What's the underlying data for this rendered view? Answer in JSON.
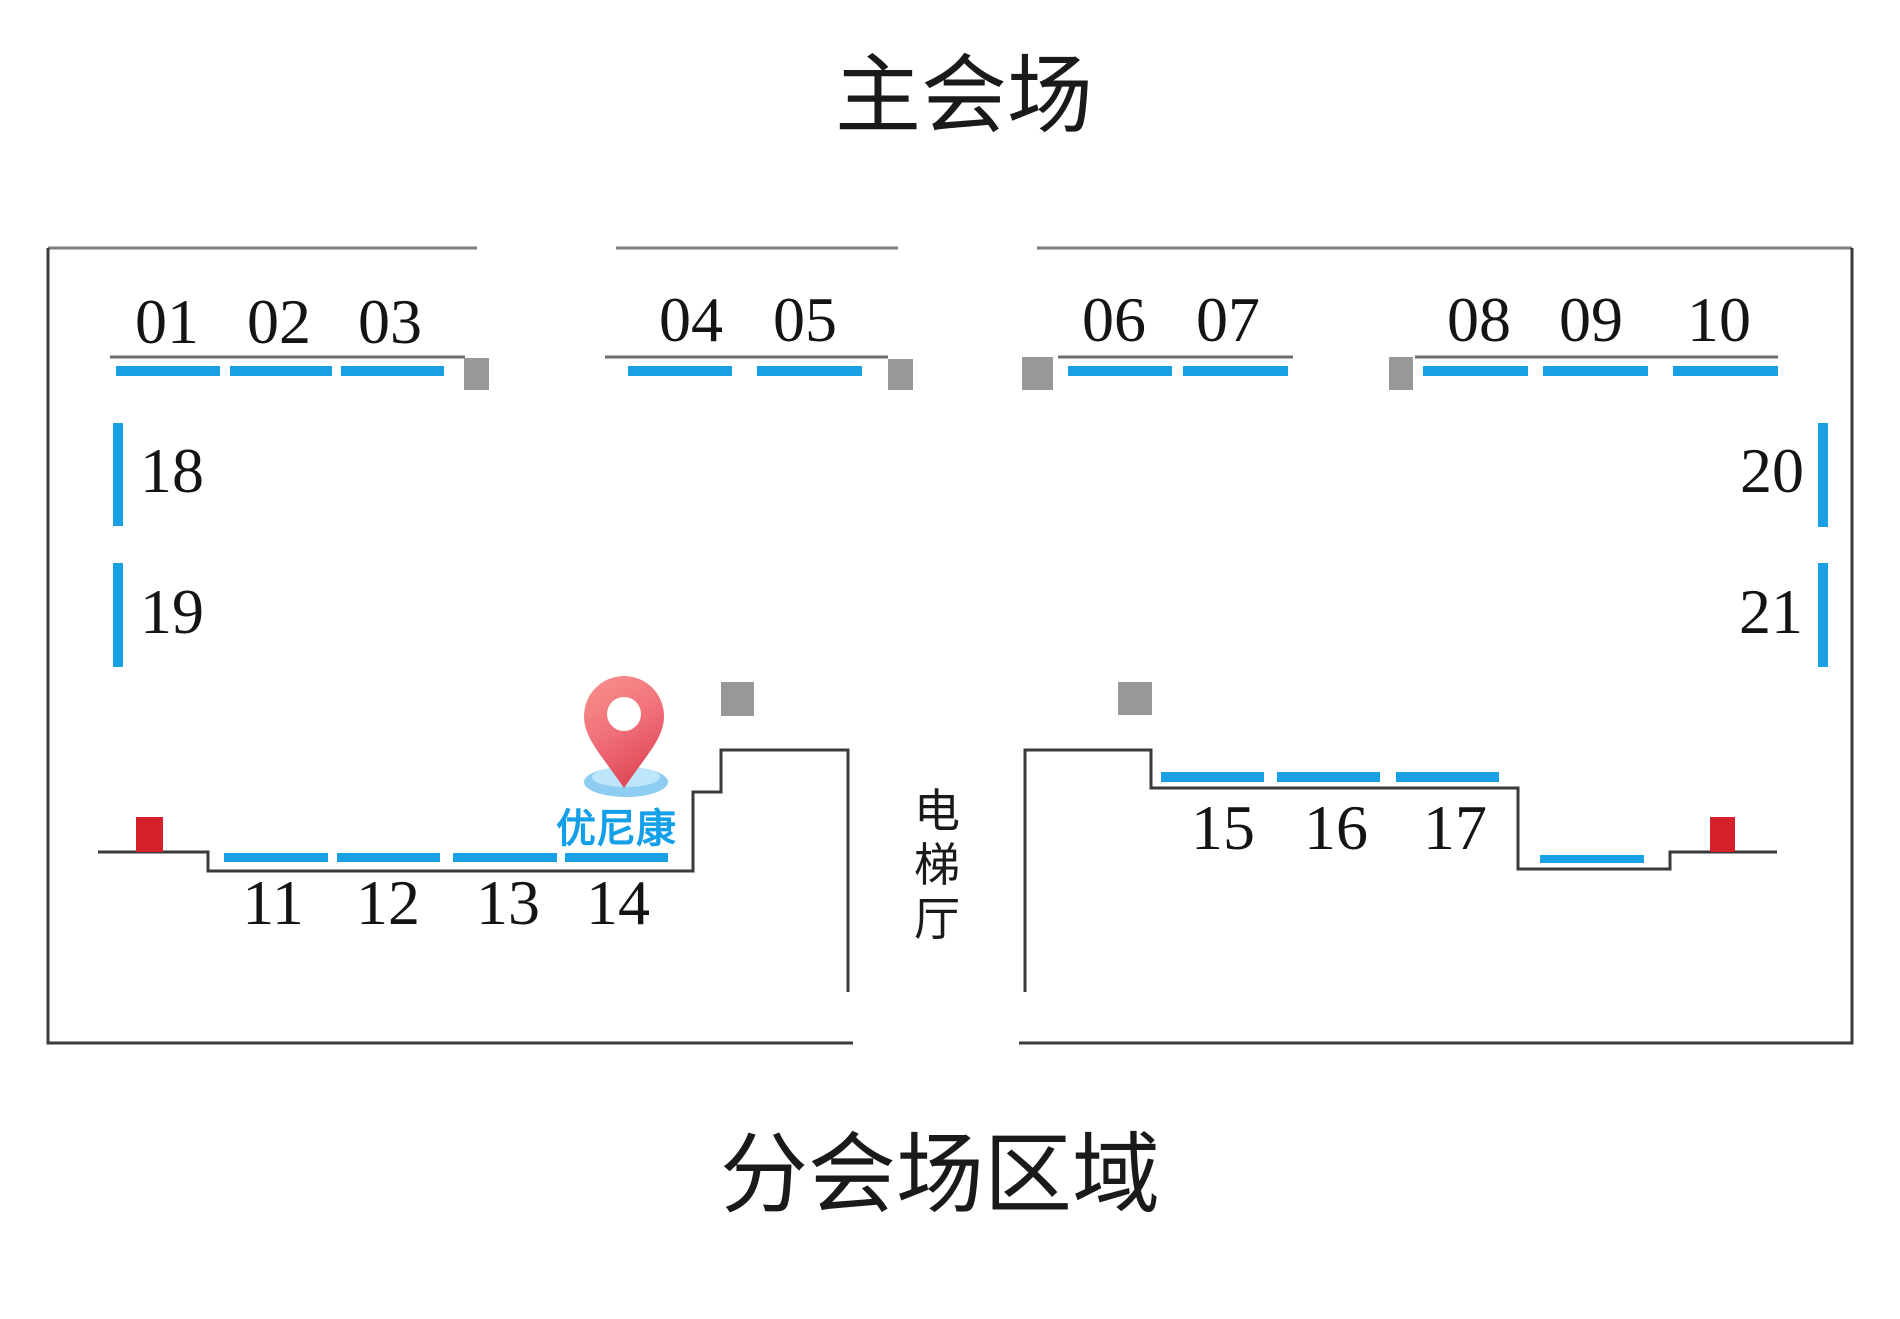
{
  "titles": {
    "main": "主会场",
    "sub": "分会场区域"
  },
  "corridor": {
    "label": "电梯厅"
  },
  "marker": {
    "label": "优尼康"
  },
  "booths": {
    "b01": "01",
    "b02": "02",
    "b03": "03",
    "b04": "04",
    "b05": "05",
    "b06": "06",
    "b07": "07",
    "b08": "08",
    "b09": "09",
    "b10": "10",
    "b11": "11",
    "b12": "12",
    "b13": "13",
    "b14": "14",
    "b15": "15",
    "b16": "16",
    "b17": "17",
    "b18": "18",
    "b19": "19",
    "b20": "20",
    "b21": "21"
  },
  "colors": {
    "booth-blue": "#189FE4",
    "door-gray": "#989898",
    "alarm-red": "#D6202C",
    "wall-dark": "#3a3a3a",
    "wall-light": "#7d7d7d",
    "label-blue": "#14A0E8",
    "pin-red": "#E85660",
    "pin-base-blue": "#8ECDF2"
  }
}
